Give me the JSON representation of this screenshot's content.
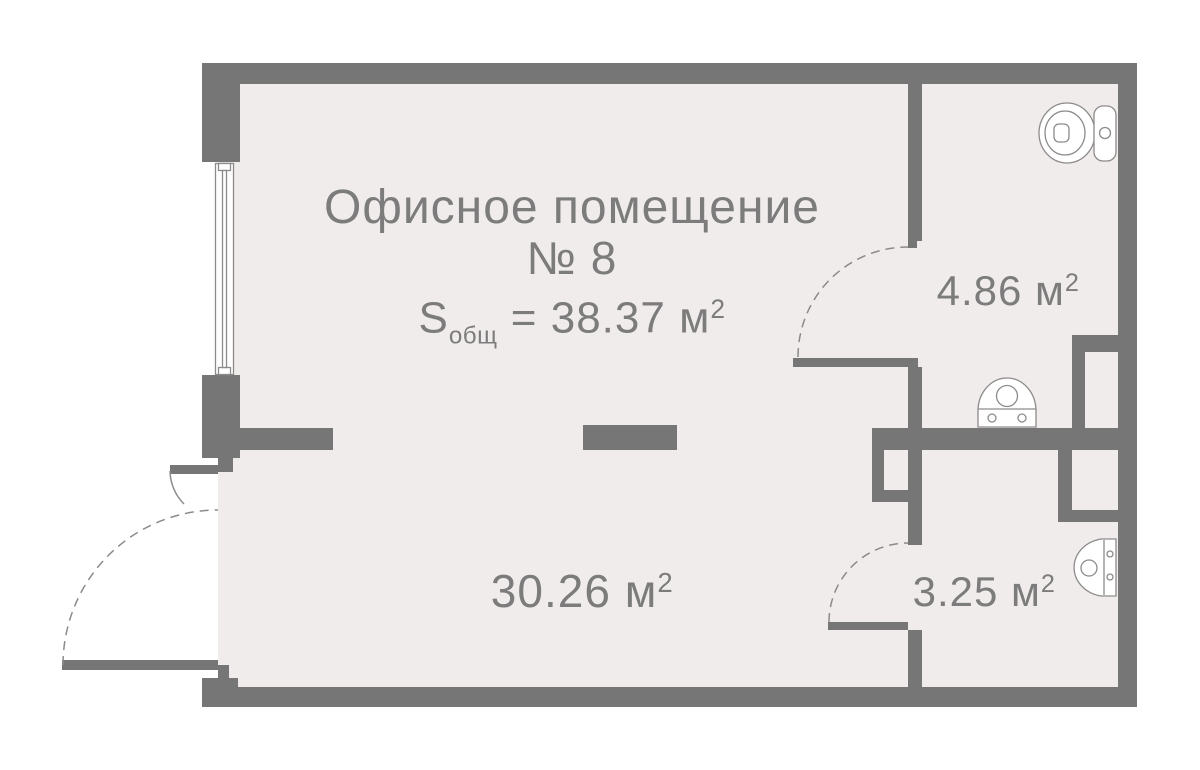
{
  "plan": {
    "title_line1": "Офисное помещение",
    "title_line2": "№ 8",
    "total_area": {
      "symbol": "S",
      "subscript": "общ",
      "equals": "=",
      "value": "38.37",
      "unit": "м",
      "sup": "2"
    },
    "rooms": [
      {
        "id": "office",
        "area": "30.26",
        "unit": "м",
        "sup": "2"
      },
      {
        "id": "wc",
        "area": "4.86",
        "unit": "м",
        "sup": "2"
      },
      {
        "id": "bathroom",
        "area": "3.25",
        "unit": "м",
        "sup": "2"
      }
    ],
    "fixtures": [
      {
        "icon": "toilet-icon",
        "room": "wc"
      },
      {
        "icon": "sink-icon",
        "room": "wc"
      },
      {
        "icon": "sink-icon",
        "room": "bathroom"
      }
    ],
    "colors": {
      "wall": "#767676",
      "floor": "#f0eceb",
      "text": "#7c7c7c",
      "line": "#8d8a8a",
      "bg": "#ffffff"
    }
  }
}
